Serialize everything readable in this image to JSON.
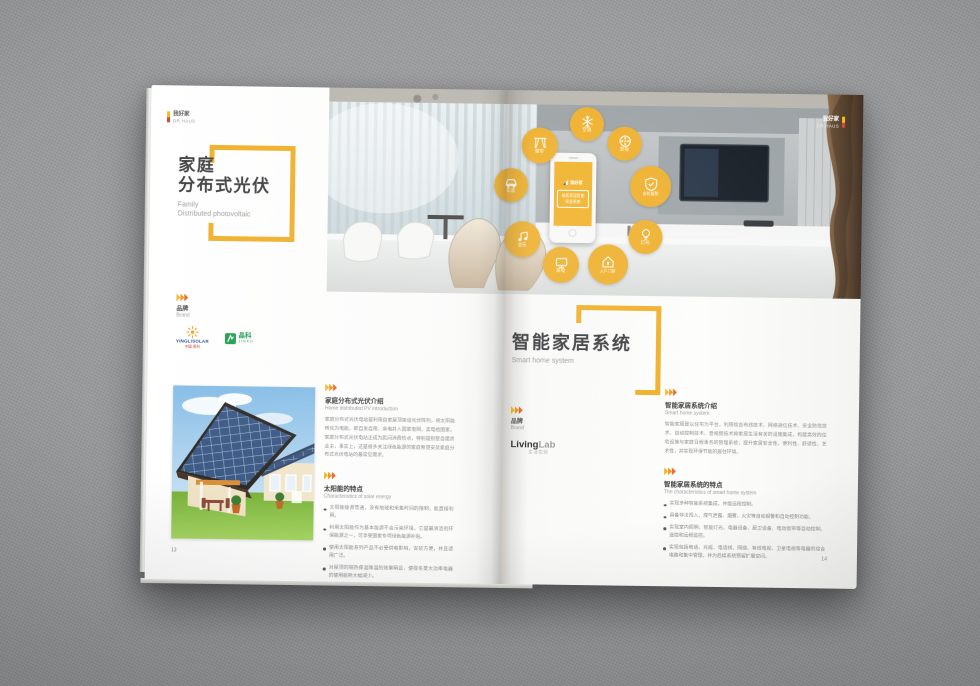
{
  "accent_color": "#efae25",
  "background_color": "#98999b",
  "publisher": {
    "cn": "我好家",
    "en": "DR.HAUS"
  },
  "left_page": {
    "page_number": "13",
    "title": {
      "cn_line1": "家庭",
      "cn_line2": "分布式光伏",
      "en_line1": "Family",
      "en_line2": "Distributed photovoltaic"
    },
    "brand": {
      "cn": "品牌",
      "en": "Brand",
      "yingli": {
        "name": "YINGLISOLAR",
        "sub": "中国·英利"
      },
      "jinko": {
        "name": "晶科",
        "sub": "JINKO"
      }
    },
    "section_intro": {
      "cn": "家庭分布式光伏介绍",
      "en": "Home distributed PV introduction",
      "body": "家庭分布式光伏电站是利用自家屋顶架设光伏阵列，将太阳能转化为电能，即自发自用，余电并入国家电网，卖电给国家。家庭分布式光伏电站正成为民间消费热点，特别是别墅自建房业主，事实上，这是很多关注绿色能源的家庭希望安装家庭分布式光伏电站的最常见需求。"
    },
    "section_features": {
      "cn": "太阳能的特点",
      "en": "Characteristics of solar energy",
      "bullets": [
        "太阳能能源普通，没有地域和采集时间的限制，能直接利用。",
        "利用太阳能作为基本能源不会污染环境，它是最清洁的环保能源之一，可享受国家专项绿色能源补贴。",
        "使用太阳能系列产品不必受供电影响，安装方便，并且适用广泛。",
        "对屋顶的隔热保温降温的效果明显，使得冬夏大功率电器的使用能耗大幅减少。"
      ]
    }
  },
  "right_page": {
    "page_number": "14",
    "title": {
      "cn": "智能家居系统",
      "en": "Smart home system"
    },
    "brand": {
      "cn": "品牌",
      "en": "Brand",
      "logo_main1": "Living",
      "logo_main2": "Lab",
      "logo_sub": "生活实验"
    },
    "section_intro": {
      "cn": "智能家居系统介绍",
      "en": "Smart home system",
      "body": "智能家居是以住宅为平台，利用综合布线技术、网络通信技术、安全防范技术、自动控制技术、音视频技术将家居生活有关的设施集成，构建高效的住宅设施与家庭日程事务的管理系统，提升家居安全性、便利性、舒适性、艺术性，并实现环保节能的居住环境。"
    },
    "section_features": {
      "cn": "智能家居系统的特点",
      "en": "The characteristics of smart home system",
      "bullets": [
        "实现多种智能系统集成，并能远程控制。",
        "具备非法闯入、煤气泄露、烟雾、火灾等自动报警和自动控制功能。",
        "实现室内照明、智能灯光、电器设备、厨卫设备、电动窗帘等自动控制、遥控和远程监控。",
        "实现包括电话、光缆、电话线、网络、有线电视、卫星电视等电器的综合电路和集中管理，并为后续系统预留扩展空间。"
      ]
    }
  },
  "photo": {
    "phone": {
      "logo": "我好家",
      "line1": "助您家居智能",
      "line2": "家居系统"
    },
    "icons": [
      {
        "id": "curtain",
        "label": "窗帘"
      },
      {
        "id": "ac",
        "label": "空调"
      },
      {
        "id": "video",
        "label": "影视"
      },
      {
        "id": "car",
        "label": "车库"
      },
      {
        "id": "security",
        "label": "安防报警"
      },
      {
        "id": "music",
        "label": "音乐"
      },
      {
        "id": "light",
        "label": "灯光"
      },
      {
        "id": "appliance",
        "label": "家电"
      },
      {
        "id": "door",
        "label": "入户门禁"
      }
    ]
  }
}
